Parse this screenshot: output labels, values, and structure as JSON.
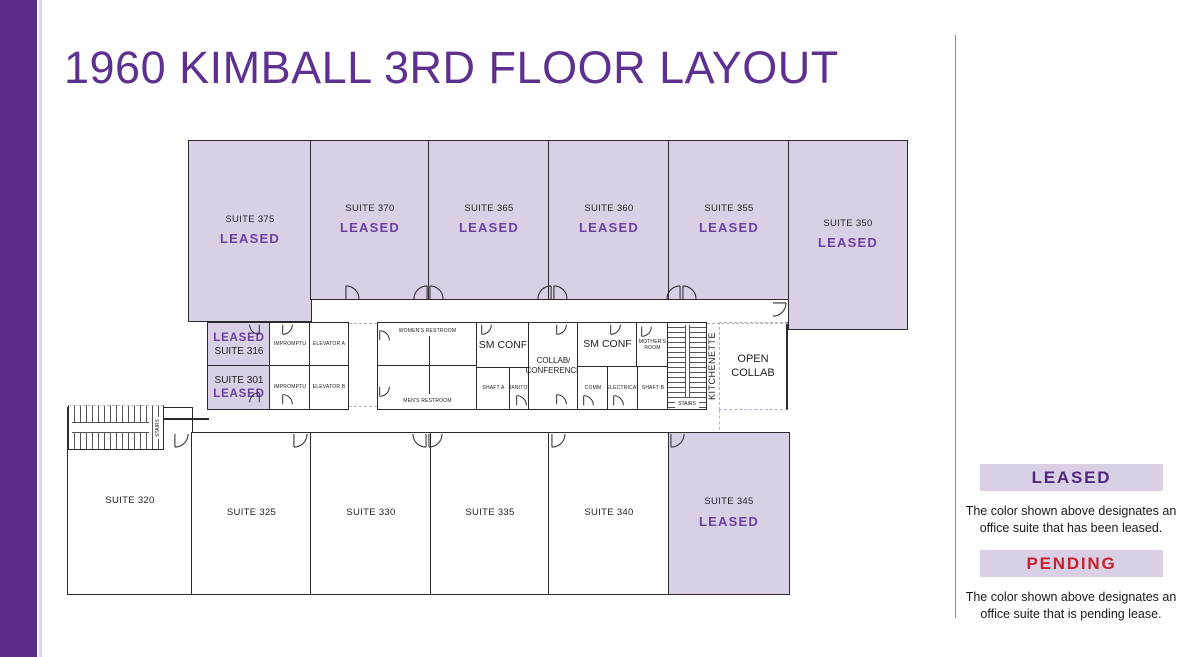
{
  "header": {
    "title": "1960 KIMBALL 3RD FLOOR LAYOUT"
  },
  "colors": {
    "brand_purple": "#5b2d87",
    "leased_fill": "#d9d0e6",
    "leased_text": "#6b3fa0",
    "pending_text": "#c5232f",
    "wall": "#2b2a2e"
  },
  "legend": {
    "leased": {
      "label": "LEASED",
      "desc": "The color shown above designates an office suite that has been leased."
    },
    "pending": {
      "label": "PENDING",
      "desc": "The color shown above designates an office suite that is pending lease."
    }
  },
  "rooms": {
    "s375": {
      "name": "SUITE 375",
      "status": "LEASED"
    },
    "s370": {
      "name": "SUITE 370",
      "status": "LEASED"
    },
    "s365": {
      "name": "SUITE 365",
      "status": "LEASED"
    },
    "s360": {
      "name": "SUITE 360",
      "status": "LEASED"
    },
    "s355": {
      "name": "SUITE 355",
      "status": "LEASED"
    },
    "s350": {
      "name": "SUITE 350",
      "status": "LEASED"
    },
    "s316": {
      "name": "SUITE 316",
      "status": "LEASED"
    },
    "s301": {
      "name": "SUITE 301",
      "status": "LEASED"
    },
    "s320": {
      "name": "SUITE 320"
    },
    "s325": {
      "name": "SUITE 325"
    },
    "s330": {
      "name": "SUITE 330"
    },
    "s335": {
      "name": "SUITE 335"
    },
    "s340": {
      "name": "SUITE 340"
    },
    "s345": {
      "name": "SUITE 345",
      "status": "LEASED"
    },
    "impromptu_a": {
      "name": "IMPROMPTU"
    },
    "impromptu_b": {
      "name": "IMPROMPTU"
    },
    "elevator_a": {
      "name": "ELEVATOR A"
    },
    "elevator_b": {
      "name": "ELEVATOR B"
    },
    "womens_restroom": {
      "name": "WOMEN'S RESTROOM"
    },
    "mens_restroom": {
      "name": "MEN'S RESTROOM"
    },
    "sm_conf_1": {
      "name": "SM CONF"
    },
    "sm_conf_2": {
      "name": "SM CONF"
    },
    "shaft_a": {
      "name": "SHAFT A"
    },
    "shaft_b": {
      "name": "SHAFT B"
    },
    "janitor": {
      "name": "JANITOR"
    },
    "comm": {
      "name": "COMM"
    },
    "electrical": {
      "name": "ELECTRICAL"
    },
    "collab_conference": {
      "line1": "COLLAB/",
      "line2": "CONFERENCE"
    },
    "mothers_room": {
      "line1": "MOTHER'S",
      "line2": "ROOM"
    },
    "open_collab": {
      "line1": "OPEN",
      "line2": "COLLAB"
    },
    "kitchenette": {
      "name": "KITCHENETTE"
    },
    "stairs_mid": {
      "name": "STAIRS"
    },
    "stairs_left": {
      "name": "STAIRS"
    }
  }
}
